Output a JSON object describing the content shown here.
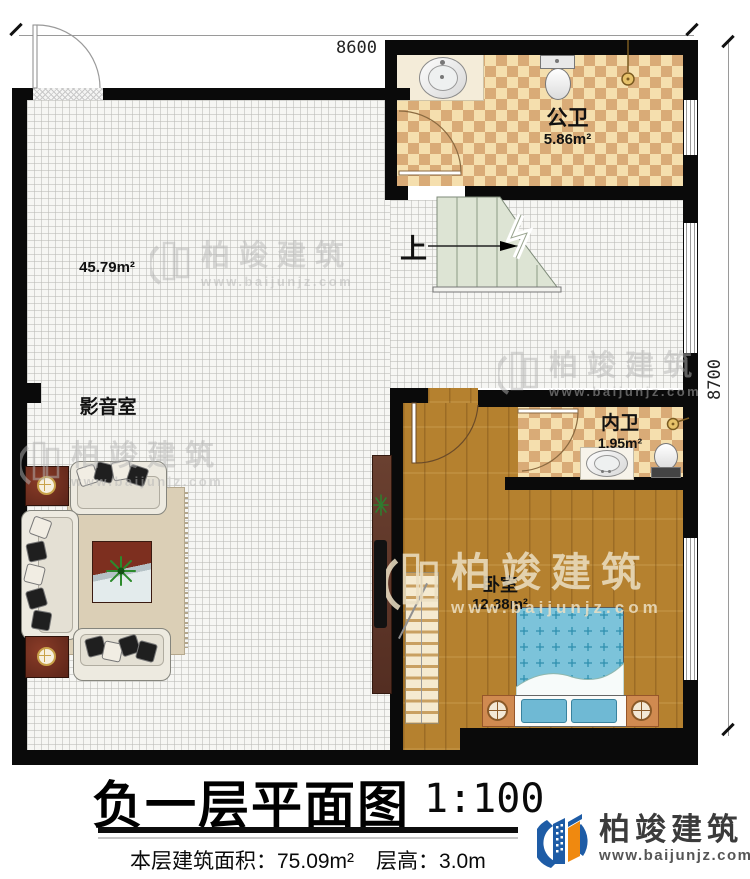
{
  "dimensions": {
    "top": "8600",
    "right": "8700"
  },
  "rooms": {
    "media_room": {
      "name": "影音室",
      "area": "45.79m²"
    },
    "public_bathroom": {
      "name": "公卫",
      "area": "5.86m²"
    },
    "inner_bathroom": {
      "name": "内卫",
      "area": "1.95m²"
    },
    "bedroom": {
      "name": "卧室",
      "area": "12.38m²"
    }
  },
  "stairs": {
    "direction_label": "上"
  },
  "title_block": {
    "title": "负一层平面图",
    "scale": "1:100",
    "floor_area": "本层建筑面积：75.09m²",
    "floor_height": "层高：3.0m"
  },
  "brand": {
    "name": "柏竣建筑",
    "website": "www.baijunjz.com"
  },
  "watermark": {
    "name": "柏竣建筑",
    "website": "www.baijunjz.com"
  },
  "colors": {
    "wall": "#0a0a0a",
    "tile_floor": "#f6f6f3",
    "bathroom_tile_light": "#f5dfae",
    "bathroom_tile_dark": "#d9ab77",
    "wood_floor": "#b5812f",
    "bed_blue": "#7cc3da",
    "brand_blue": "#1e5ca6",
    "brand_orange": "#f0890f"
  }
}
